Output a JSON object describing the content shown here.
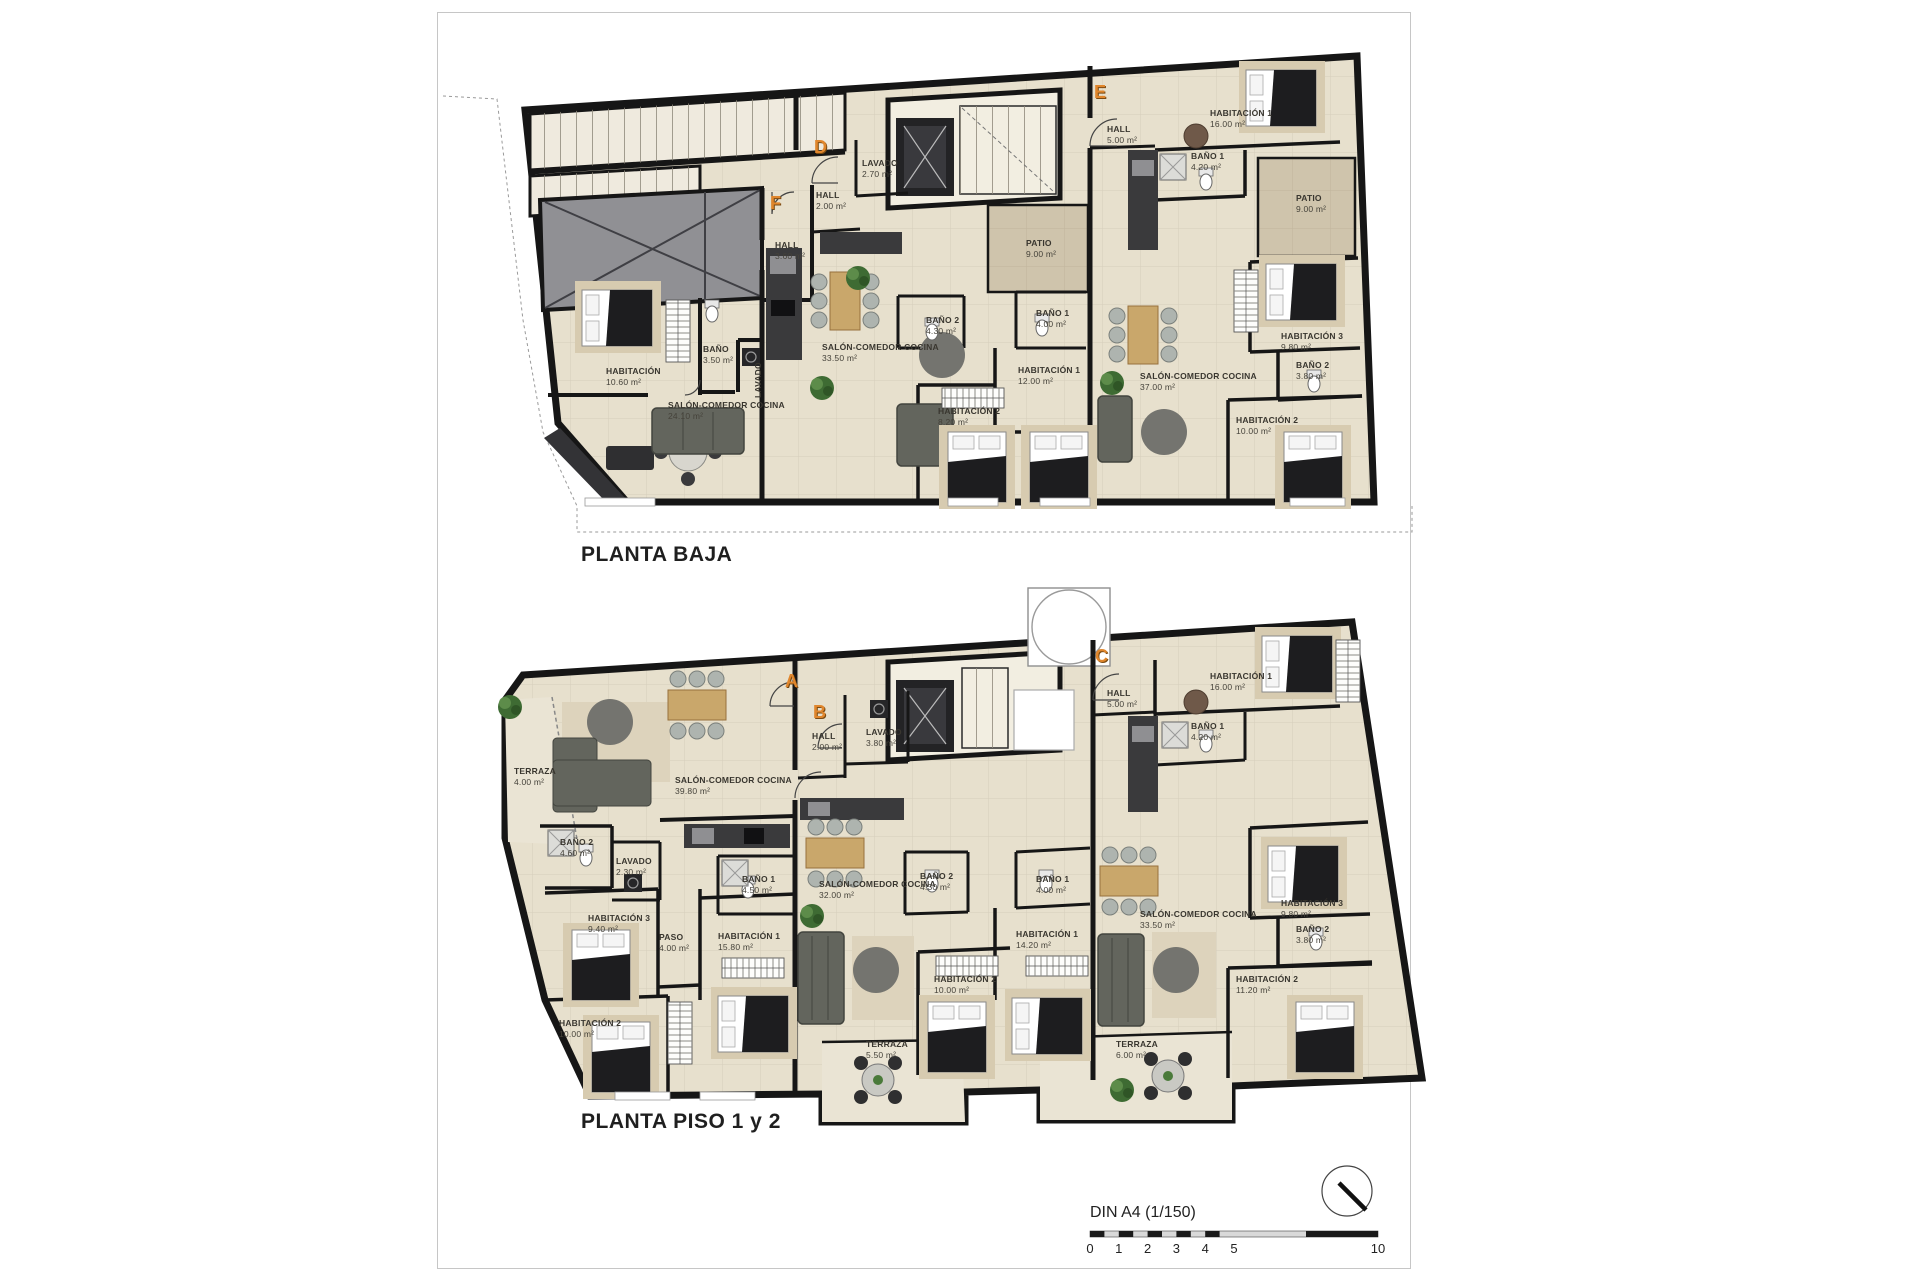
{
  "page": {
    "background": "#ffffff",
    "accent_orange": "#e0862c",
    "wall_color": "#161616",
    "floor_color": "#e7e0cd"
  },
  "plans": [
    {
      "id": "planta-baja",
      "title": "PLANTA BAJA",
      "unit_letters": [
        {
          "label": "F",
          "pos": [
            770,
            193
          ]
        },
        {
          "label": "D",
          "pos": [
            814,
            137
          ]
        },
        {
          "label": "E",
          "pos": [
            1094,
            82
          ]
        }
      ],
      "room_labels": [
        {
          "n": "HALL",
          "a": "3.60 m²",
          "p": [
            775,
            240
          ]
        },
        {
          "n": "HABITACIÓN",
          "a": "10.60 m²",
          "p": [
            606,
            366
          ]
        },
        {
          "n": "BAÑO",
          "a": "3.50 m²",
          "p": [
            703,
            344
          ]
        },
        {
          "n": "LAVADO",
          "a": "",
          "p": [
            753,
            398
          ],
          "rot": true
        },
        {
          "n": "SALÓN-COMEDOR COCINA",
          "a": "24.10 m²",
          "p": [
            668,
            400
          ]
        },
        {
          "n": "HALL",
          "a": "2.00 m²",
          "p": [
            816,
            190
          ]
        },
        {
          "n": "LAVADO",
          "a": "2.70 m²",
          "p": [
            862,
            158
          ]
        },
        {
          "n": "BAÑO 2",
          "a": "4.30 m²",
          "p": [
            926,
            315
          ]
        },
        {
          "n": "BAÑO 1",
          "a": "4.00 m²",
          "p": [
            1036,
            308
          ]
        },
        {
          "n": "HABITACIÓN 1",
          "a": "12.00 m²",
          "p": [
            1018,
            365
          ]
        },
        {
          "n": "HABITACIÓN 2",
          "a": "8.20 m²",
          "p": [
            938,
            406
          ]
        },
        {
          "n": "SALÓN-COMEDOR COCINA",
          "a": "33.50 m²",
          "p": [
            822,
            342
          ]
        },
        {
          "n": "PATIO",
          "a": "9.00 m²",
          "p": [
            1026,
            238
          ]
        },
        {
          "n": "HALL",
          "a": "5.00 m²",
          "p": [
            1107,
            124
          ]
        },
        {
          "n": "HABITACIÓN 1",
          "a": "16.00 m²",
          "p": [
            1210,
            108
          ]
        },
        {
          "n": "BAÑO 1",
          "a": "4.20 m²",
          "p": [
            1191,
            151
          ]
        },
        {
          "n": "PATIO",
          "a": "9.00 m²",
          "p": [
            1296,
            193
          ]
        },
        {
          "n": "HABITACIÓN 3",
          "a": "9.80 m²",
          "p": [
            1281,
            331
          ]
        },
        {
          "n": "BAÑO 2",
          "a": "3.80 m²",
          "p": [
            1296,
            360
          ]
        },
        {
          "n": "HABITACIÓN 2",
          "a": "10.00 m²",
          "p": [
            1236,
            415
          ]
        },
        {
          "n": "SALÓN-COMEDOR COCINA",
          "a": "37.00 m²",
          "p": [
            1140,
            371
          ]
        }
      ]
    },
    {
      "id": "planta-piso-1-y-2",
      "title": "PLANTA PISO 1 y 2",
      "unit_letters": [
        {
          "label": "A",
          "pos": [
            785,
            671
          ]
        },
        {
          "label": "B",
          "pos": [
            813,
            702
          ]
        },
        {
          "label": "C",
          "pos": [
            1095,
            646
          ]
        }
      ],
      "room_labels": [
        {
          "n": "TERRAZA",
          "a": "4.00 m²",
          "p": [
            514,
            766
          ]
        },
        {
          "n": "SALÓN-COMEDOR COCINA",
          "a": "39.80 m²",
          "p": [
            675,
            775
          ]
        },
        {
          "n": "BAÑO 2",
          "a": "4.60 m²",
          "p": [
            560,
            837
          ]
        },
        {
          "n": "LAVADO",
          "a": "2.30 m²",
          "p": [
            616,
            856
          ]
        },
        {
          "n": "HABITACIÓN 3",
          "a": "9.40 m²",
          "p": [
            588,
            913
          ]
        },
        {
          "n": "PASO",
          "a": "4.00 m²",
          "p": [
            659,
            932
          ]
        },
        {
          "n": "HABITACIÓN 1",
          "a": "15.80 m²",
          "p": [
            718,
            931
          ]
        },
        {
          "n": "HABITACIÓN 2",
          "a": "10.00 m²",
          "p": [
            559,
            1018
          ]
        },
        {
          "n": "HALL",
          "a": "2.00 m²",
          "p": [
            812,
            731
          ]
        },
        {
          "n": "LAVADO",
          "a": "3.80 m²",
          "p": [
            866,
            727
          ]
        },
        {
          "n": "BAÑO 1",
          "a": "4.50 m²",
          "p": [
            742,
            874
          ]
        },
        {
          "n": "SALÓN-COMEDOR COCINA",
          "a": "32.00 m²",
          "p": [
            819,
            879
          ]
        },
        {
          "n": "BAÑO 2",
          "a": "4.30 m²",
          "p": [
            920,
            871
          ]
        },
        {
          "n": "BAÑO 1",
          "a": "4.00 m²",
          "p": [
            1036,
            874
          ]
        },
        {
          "n": "HABITACIÓN 1",
          "a": "14.20 m²",
          "p": [
            1016,
            929
          ]
        },
        {
          "n": "HABITACIÓN 2",
          "a": "10.00 m²",
          "p": [
            934,
            974
          ]
        },
        {
          "n": "TERRAZA",
          "a": "5.50 m²",
          "p": [
            866,
            1039
          ]
        },
        {
          "n": "HALL",
          "a": "5.00 m²",
          "p": [
            1107,
            688
          ]
        },
        {
          "n": "HABITACIÓN 1",
          "a": "16.00 m²",
          "p": [
            1210,
            671
          ]
        },
        {
          "n": "BAÑO 1",
          "a": "4.20 m²",
          "p": [
            1191,
            721
          ]
        },
        {
          "n": "SALÓN-COMEDOR COCINA",
          "a": "33.50 m²",
          "p": [
            1140,
            909
          ]
        },
        {
          "n": "HABITACIÓN 3",
          "a": "9.80 m²",
          "p": [
            1281,
            898
          ]
        },
        {
          "n": "BAÑO 2",
          "a": "3.80 m²",
          "p": [
            1296,
            924
          ]
        },
        {
          "n": "HABITACIÓN 2",
          "a": "11.20 m²",
          "p": [
            1236,
            974
          ]
        },
        {
          "n": "TERRAZA",
          "a": "6.00 m²",
          "p": [
            1116,
            1039
          ]
        }
      ]
    }
  ],
  "scale_bar": {
    "title": "DIN A4 (1/150)",
    "ticks": [
      {
        "label": "0",
        "m": 0
      },
      {
        "label": "1",
        "m": 1
      },
      {
        "label": "2",
        "m": 2
      },
      {
        "label": "3",
        "m": 3
      },
      {
        "label": "4",
        "m": 4
      },
      {
        "label": "5",
        "m": 5
      },
      {
        "label": "10",
        "m": 10
      }
    ]
  }
}
